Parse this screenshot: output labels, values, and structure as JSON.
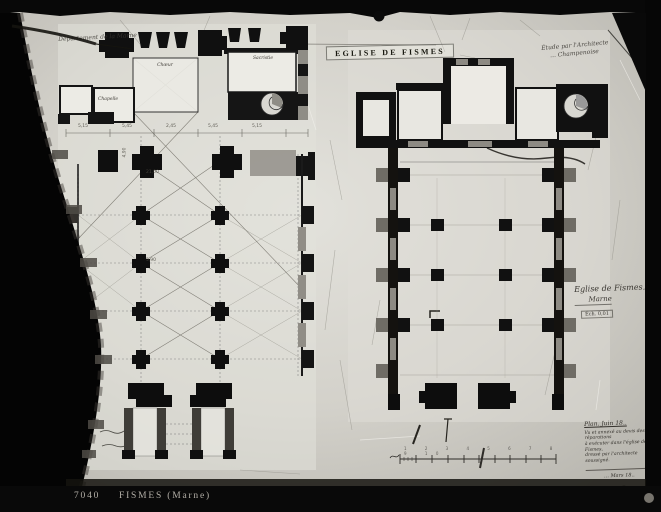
{
  "photo_plate": {
    "archive_number": "7040",
    "caption": "FISMES (Marne)"
  },
  "drawing": {
    "title": "EGLISE DE FISMES",
    "department_note": "Département de la Marne",
    "architect_note": {
      "line1": "Étude par l'Architecte",
      "line2": "… Champenoise"
    },
    "cartouche": {
      "line1": "Eglise de Fismes.",
      "line2": "Marne",
      "scale_note": "Éch. 0,01"
    },
    "room_labels": {
      "choir": "Chœur",
      "sacristy": "Sacristie",
      "chapel": "Chapelle"
    },
    "bottom_note": {
      "heading": "Plan. Juin 18..",
      "line1": "Vu et annexé au devis des réparations",
      "line2": "à exécuter dans l'église de Fismes,",
      "line3": "dressé par l'architecte soussigné.",
      "date": "… Mars 18.."
    },
    "scale_tick_numbers": "1 2 3 4 5 6 7 8 9 10",
    "dimensions": [
      "5,15",
      "5,45",
      "2,45",
      "5,45",
      "5,15",
      "21,00",
      "4,90",
      "5,90"
    ]
  },
  "colors": {
    "plate_black": "#070707",
    "paper": "#d3d1ca",
    "plan_paper": "#ecebe5",
    "ink": "#111111",
    "caption_text": "#b3afa7"
  }
}
